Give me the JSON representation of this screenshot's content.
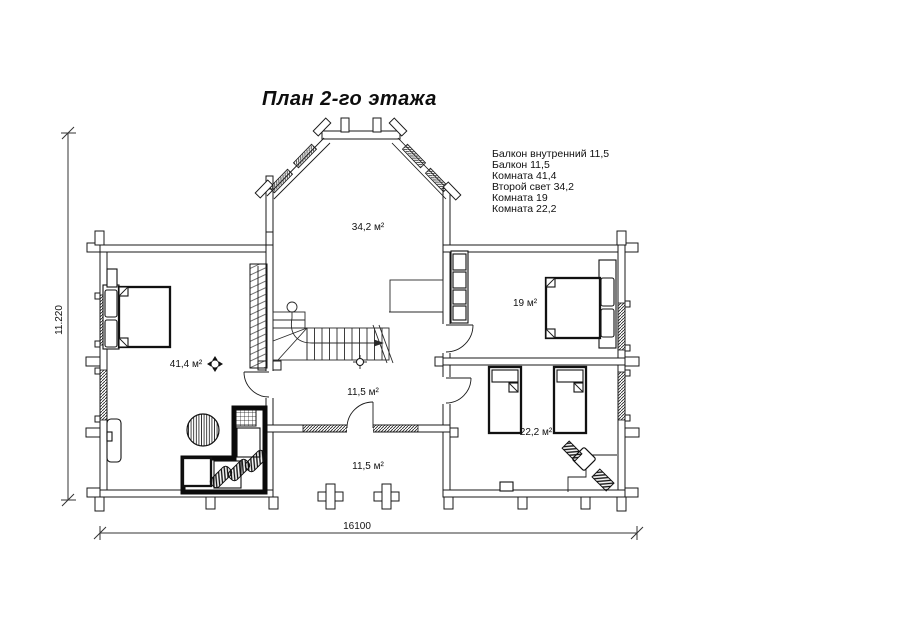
{
  "title": "План 2-го этажа",
  "legend": {
    "items": [
      "Балкон внутренний 11,5",
      "Балкон 11,5",
      "Комната 41,4",
      "Второй свет 34,2",
      "Комната 19",
      "Комната 22,2"
    ]
  },
  "room_labels": {
    "second_light": "34,2 м²",
    "bedroom_19": "19 м²",
    "bedroom_41": "41,4 м²",
    "inner_balcony": "11,5 м²",
    "bedroom_22": "22,2 м²",
    "balcony": "11,5 м²"
  },
  "dimensions": {
    "vertical": "11.220",
    "horizontal": "16100"
  },
  "colors": {
    "line": "#1a1a1a",
    "background": "#ffffff"
  }
}
